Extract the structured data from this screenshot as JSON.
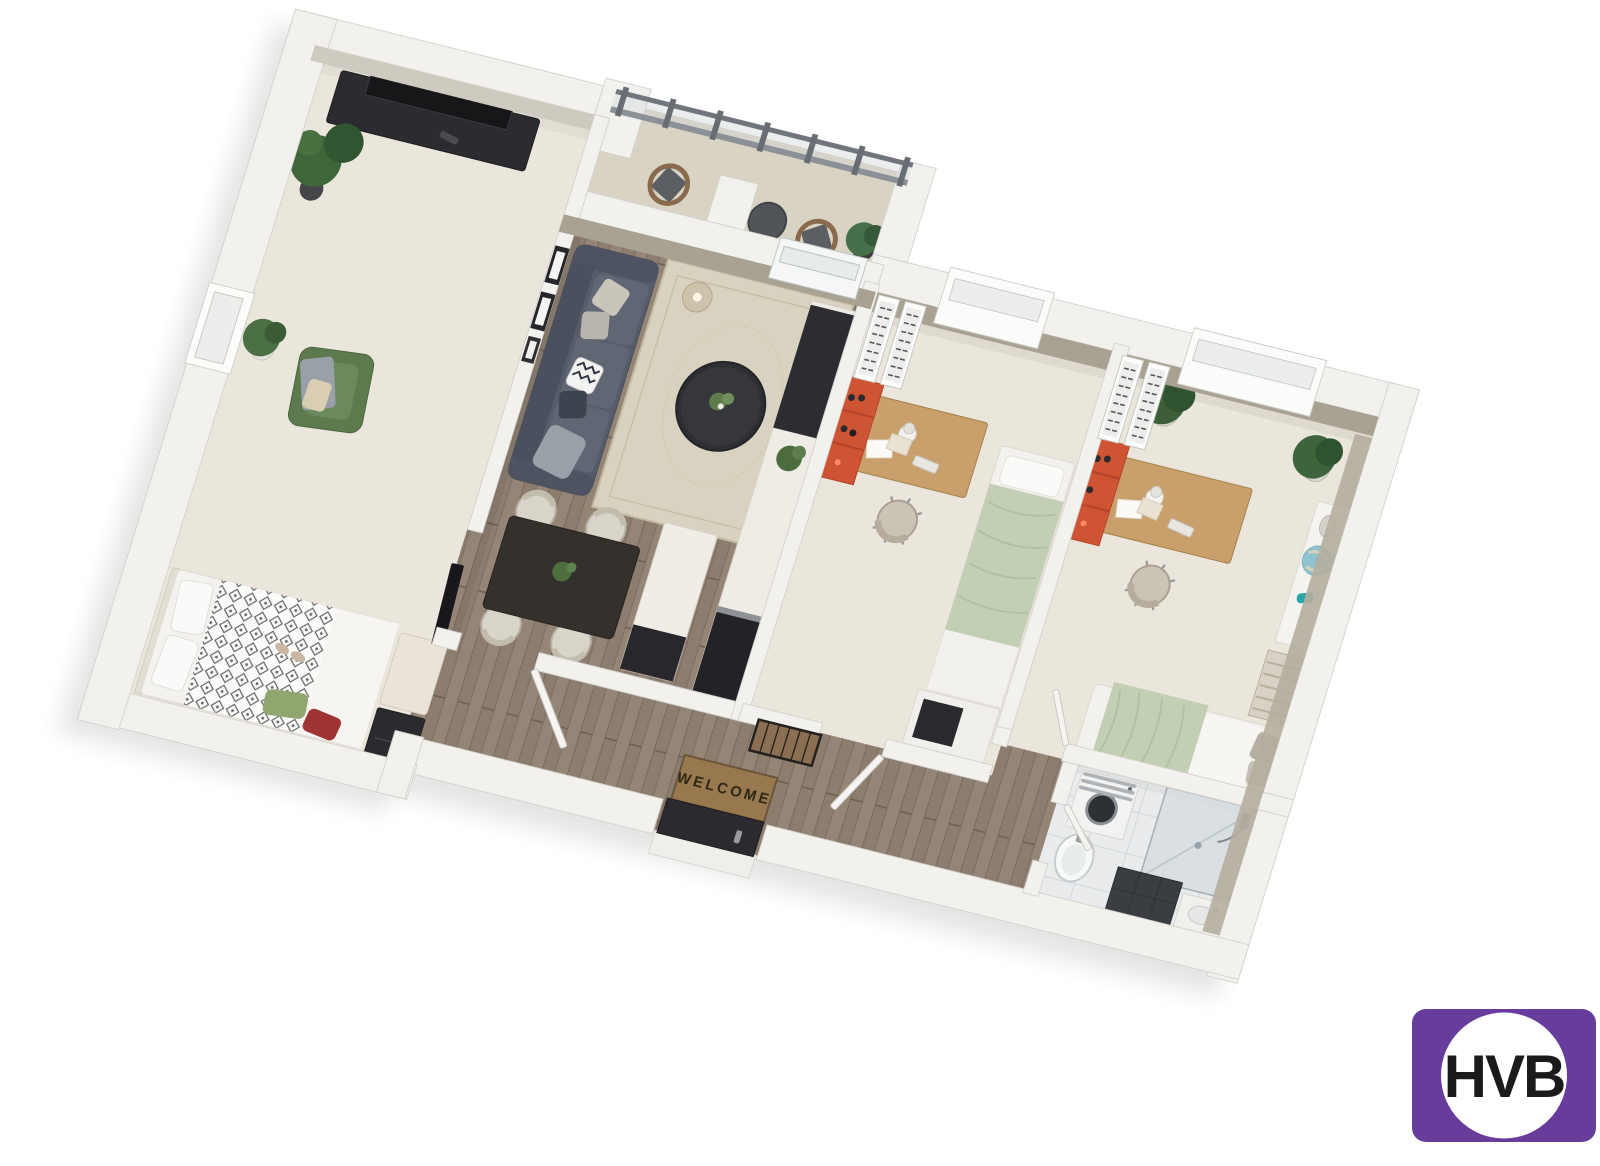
{
  "meta": {
    "description": "3D isometric bird's-eye floor plan rendering of an apartment",
    "projection": "axonometric, rotated clockwise"
  },
  "entrance": {
    "mat_text": "WELCOME"
  },
  "branding": {
    "logo_text": "HVB",
    "logo_background": "#683c9a",
    "logo_emblem": "white-circle",
    "logo_text_color": "#1b1b1b"
  },
  "palette": {
    "wall": "#f2f1ee",
    "wall_inner_face": "#a9a192",
    "carpet": "#ebe6db",
    "wood_floor": "#8c7d6e",
    "balcony_floor": "#d9d3c4",
    "bath_tile": "#e9ebec",
    "sofa": "#575c6a",
    "bed_sage": "#c3cfb4",
    "armchair_green": "#5d7a4e",
    "accent_orange": "#cf5433",
    "dark_furniture": "#2c2c30"
  },
  "floor_plan": {
    "rooms": [
      {
        "name": "Balcony",
        "floor": "tile",
        "items": [
          "railing",
          "lounge chair",
          "lounge chair",
          "round table",
          "potted plant",
          "potted plant"
        ]
      },
      {
        "name": "Bedroom / TV room (left)",
        "floor": "carpet",
        "items": [
          "tv sideboard",
          "tv",
          "corner plants",
          "potted plant",
          "green armchair",
          "double bed with diamond duvet",
          "green pillow",
          "red pillow",
          "bench",
          "dresser",
          "wall art frames",
          "wall tv panel"
        ]
      },
      {
        "name": "Living & dining room",
        "floor": "wood",
        "items": [
          "sofa with pillows",
          "area rug",
          "round coffee table",
          "pendant lamp",
          "dining table",
          "dining chair",
          "dining chair",
          "dining chair",
          "dining chair",
          "kitchen counter",
          "kitchen island"
        ]
      },
      {
        "name": "Bedroom (middle)",
        "floor": "carpet",
        "items": [
          "radiator",
          "radiator",
          "orange shelf with bottles",
          "desk",
          "desk lamp",
          "keyboard",
          "desk chair",
          "single bed (sage)",
          "wardrobe cube"
        ]
      },
      {
        "name": "Bedroom (right)",
        "floor": "carpet",
        "items": [
          "radiator",
          "radiator",
          "orange shelf with bottles",
          "desk",
          "desk lamp",
          "keyboard",
          "desk chair",
          "potted plant",
          "potted plant",
          "sideboard with globe and bust",
          "slatted radiator",
          "single bed (sage)"
        ]
      },
      {
        "name": "Hallway",
        "floor": "wood",
        "items": [
          "welcome mat",
          "entrance door",
          "slatted coat rack",
          "open doors"
        ]
      },
      {
        "name": "Bathroom",
        "floor": "tile",
        "items": [
          "washing machine",
          "towel rack",
          "walk-in glass shower",
          "pedestal sink",
          "dark tiled tray",
          "vanity sink"
        ]
      }
    ]
  }
}
